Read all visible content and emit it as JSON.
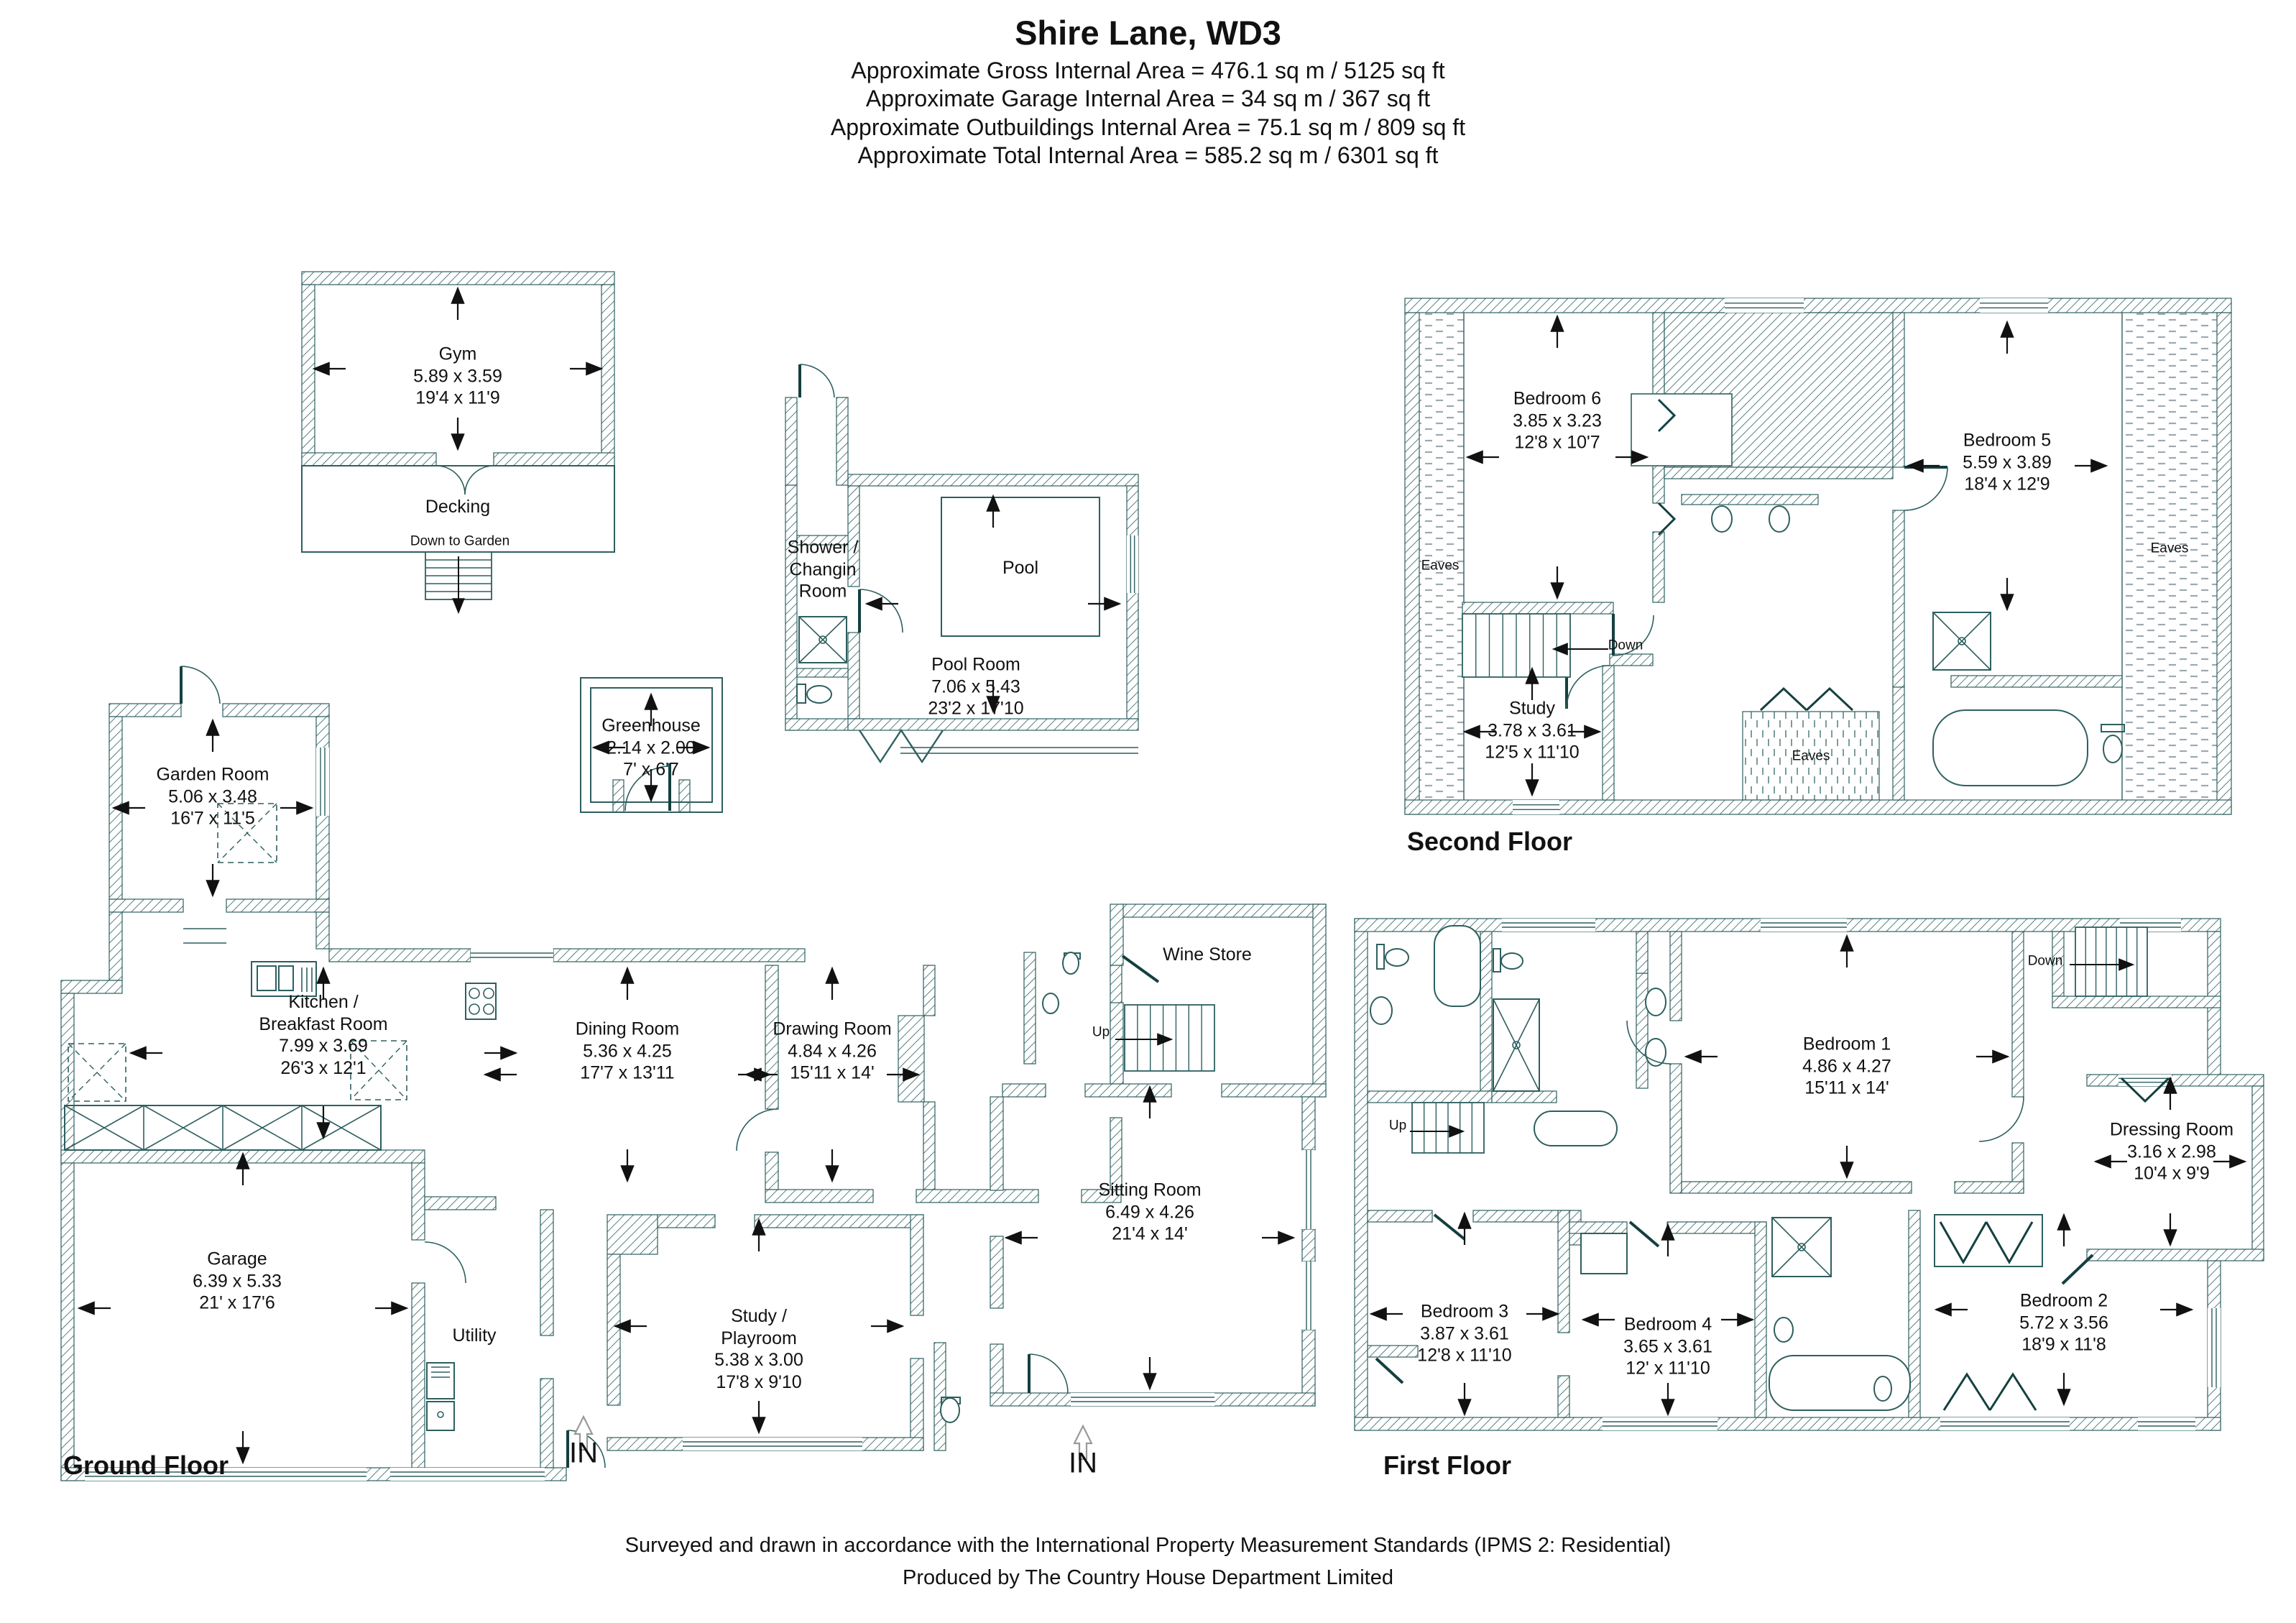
{
  "colors": {
    "wall": "#2e5f5f",
    "text": "#111111",
    "eaves_dash": "#9aaab0"
  },
  "header": {
    "title": "Shire Lane, WD3",
    "lines": [
      "Approximate Gross Internal Area = 476.1 sq m / 5125 sq ft",
      "Approximate Garage Internal Area = 34 sq m / 367 sq ft",
      "Approximate Outbuildings Internal Area = 75.1 sq m / 809 sq ft",
      "Approximate Total Internal Area = 585.2 sq m / 6301 sq ft"
    ]
  },
  "outbuildings": {
    "gym": {
      "name": "Gym",
      "metric": "5.89 x 3.59",
      "imperial": "19'4 x 11'9"
    },
    "decking": {
      "name": "Decking"
    },
    "down_to_garden": "Down to Garden",
    "greenhouse": {
      "name": "Greenhouse",
      "metric": "2.14 x 2.00",
      "imperial": "7' x 6'7"
    },
    "shower_room": {
      "line1": "Shower /",
      "line2": "Changin",
      "line3": "Room"
    },
    "pool": {
      "name": "Pool"
    },
    "pool_room": {
      "name": "Pool Room",
      "metric": "7.06 x 5.43",
      "imperial": "23'2 x 17'10"
    }
  },
  "second_floor": {
    "title": "Second Floor",
    "bedroom6": {
      "name": "Bedroom 6",
      "metric": "3.85 x 3.23",
      "imperial": "12'8 x 10'7"
    },
    "bedroom5": {
      "name": "Bedroom 5",
      "metric": "5.59 x 3.89",
      "imperial": "18'4 x 12'9"
    },
    "study": {
      "name": "Study",
      "metric": "3.78 x 3.61",
      "imperial": "12'5 x 11'10"
    },
    "eaves": "Eaves",
    "down": "Down"
  },
  "ground_floor": {
    "title": "Ground Floor",
    "garden_room": {
      "name": "Garden Room",
      "metric": "5.06 x 3.48",
      "imperial": "16'7 x 11'5"
    },
    "kitchen": {
      "line1": "Kitchen /",
      "line2": "Breakfast Room",
      "metric": "7.99 x 3.69",
      "imperial": "26'3 x 12'1"
    },
    "dining": {
      "name": "Dining Room",
      "metric": "5.36 x 4.25",
      "imperial": "17'7 x 13'11"
    },
    "drawing": {
      "name": "Drawing Room",
      "metric": "4.84 x 4.26",
      "imperial": "15'11 x 14'"
    },
    "wine_store": {
      "name": "Wine Store"
    },
    "sitting": {
      "name": "Sitting Room",
      "metric": "6.49 x 4.26",
      "imperial": "21'4 x 14'"
    },
    "garage": {
      "name": "Garage",
      "metric": "6.39 x 5.33",
      "imperial": "21' x 17'6"
    },
    "utility": {
      "name": "Utility"
    },
    "study_playroom": {
      "line1": "Study /",
      "line2": "Playroom",
      "metric": "5.38 x 3.00",
      "imperial": "17'8 x 9'10"
    },
    "up": "Up",
    "in": "IN"
  },
  "first_floor": {
    "title": "First Floor",
    "bedroom1": {
      "name": "Bedroom 1",
      "metric": "4.86 x 4.27",
      "imperial": "15'11 x 14'"
    },
    "bedroom2": {
      "name": "Bedroom 2",
      "metric": "5.72 x 3.56",
      "imperial": "18'9 x 11'8"
    },
    "bedroom3": {
      "name": "Bedroom 3",
      "metric": "3.87 x 3.61",
      "imperial": "12'8 x 11'10"
    },
    "bedroom4": {
      "name": "Bedroom 4",
      "metric": "3.65 x 3.61",
      "imperial": "12' x 11'10"
    },
    "dressing": {
      "name": "Dressing Room",
      "metric": "3.16 x 2.98",
      "imperial": "10'4 x 9'9"
    },
    "up": "Up",
    "down": "Down"
  },
  "footer": {
    "line1": "Surveyed and drawn in accordance with the International Property Measurement Standards (IPMS 2: Residential)",
    "line2": "Produced by The Country House Department Limited"
  }
}
